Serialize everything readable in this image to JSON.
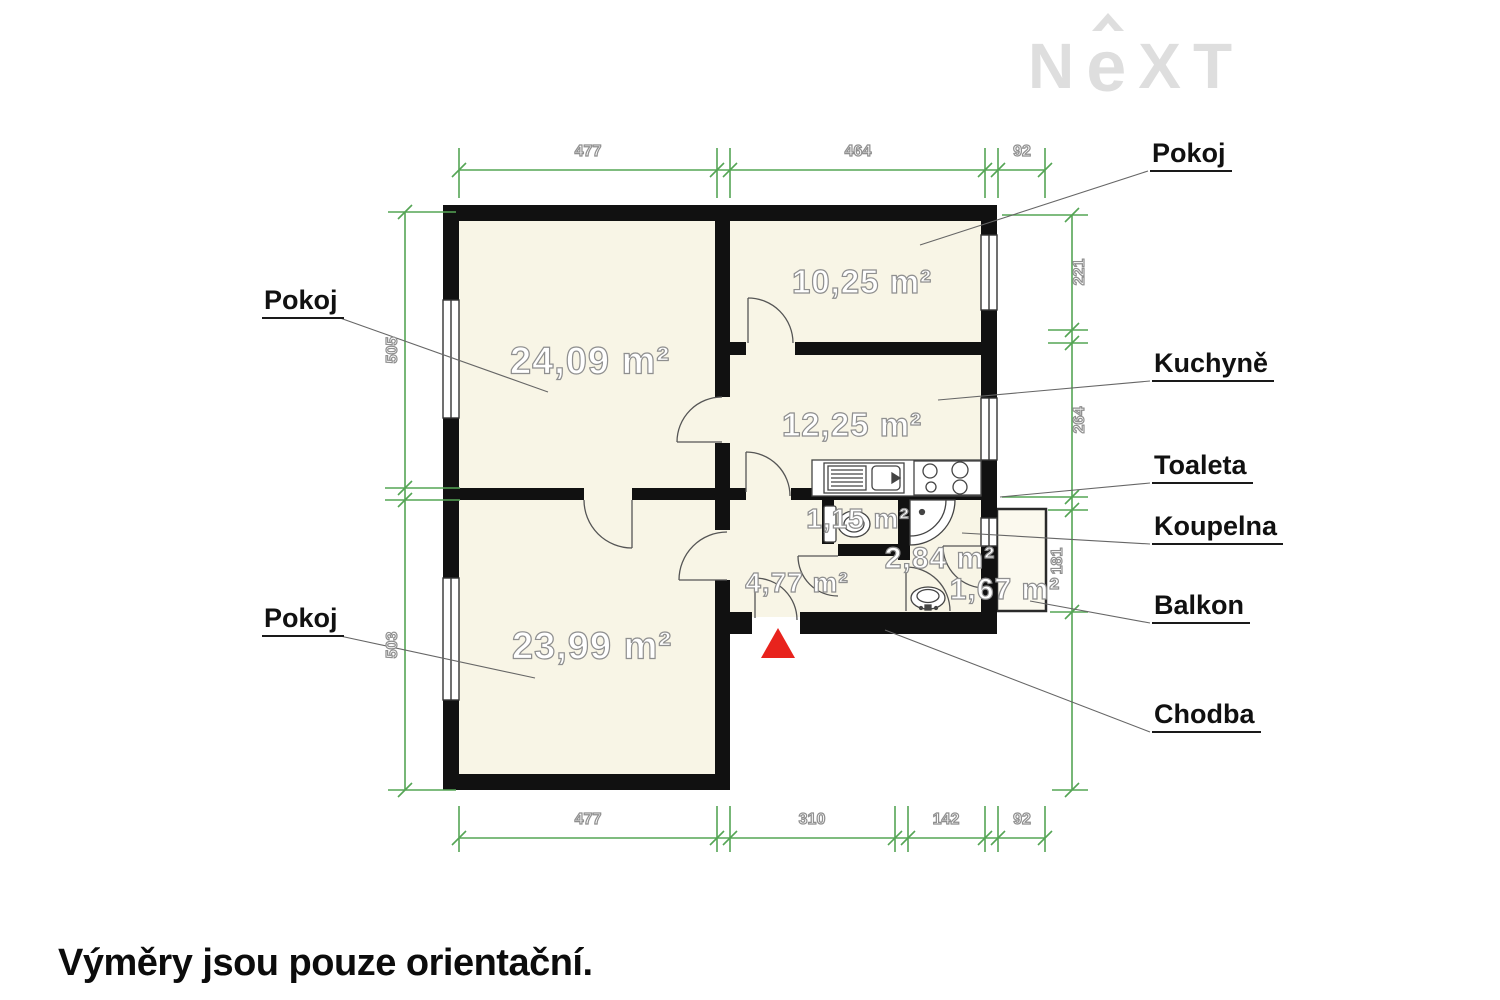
{
  "logo": {
    "part_n": "N",
    "part_e": "e",
    "part_x": "X",
    "part_t": "T"
  },
  "disclaimer": "Výměry jsou pouze orientační.",
  "areas": {
    "pokoj_top_left": "24,09 m²",
    "pokoj_top_right": "10,25 m²",
    "kuchyne": "12,25 m²",
    "pokoj_bottom_left": "23,99 m²",
    "toaleta": "1,15 m²",
    "koupelna": "2,84 m²",
    "chodba": "4,77 m²",
    "balkon": "1,67 m²"
  },
  "callouts": {
    "pokoj_left_top": "Pokoj",
    "pokoj_left_bottom": "Pokoj",
    "pokoj_right": "Pokoj",
    "kuchyne": "Kuchyně",
    "toaleta": "Toaleta",
    "koupelna": "Koupelna",
    "balkon": "Balkon",
    "chodba": "Chodba"
  },
  "dimensions": {
    "top": {
      "d1": "477",
      "d2": "464",
      "d3": "92"
    },
    "bottom": {
      "d1": "477",
      "d2": "310",
      "d3": "142",
      "d4": "92"
    },
    "left": {
      "d1": "505",
      "d2": "503"
    },
    "right": {
      "d1": "221",
      "d2": "264",
      "d3": "181"
    }
  },
  "colors": {
    "wall": "#111111",
    "room_fill": "#f8f5e6",
    "dimension_green": "#55a555",
    "entrance_red": "#e8231d",
    "logo_gray": "#dedede",
    "outline_text": "#8f8f8f"
  }
}
